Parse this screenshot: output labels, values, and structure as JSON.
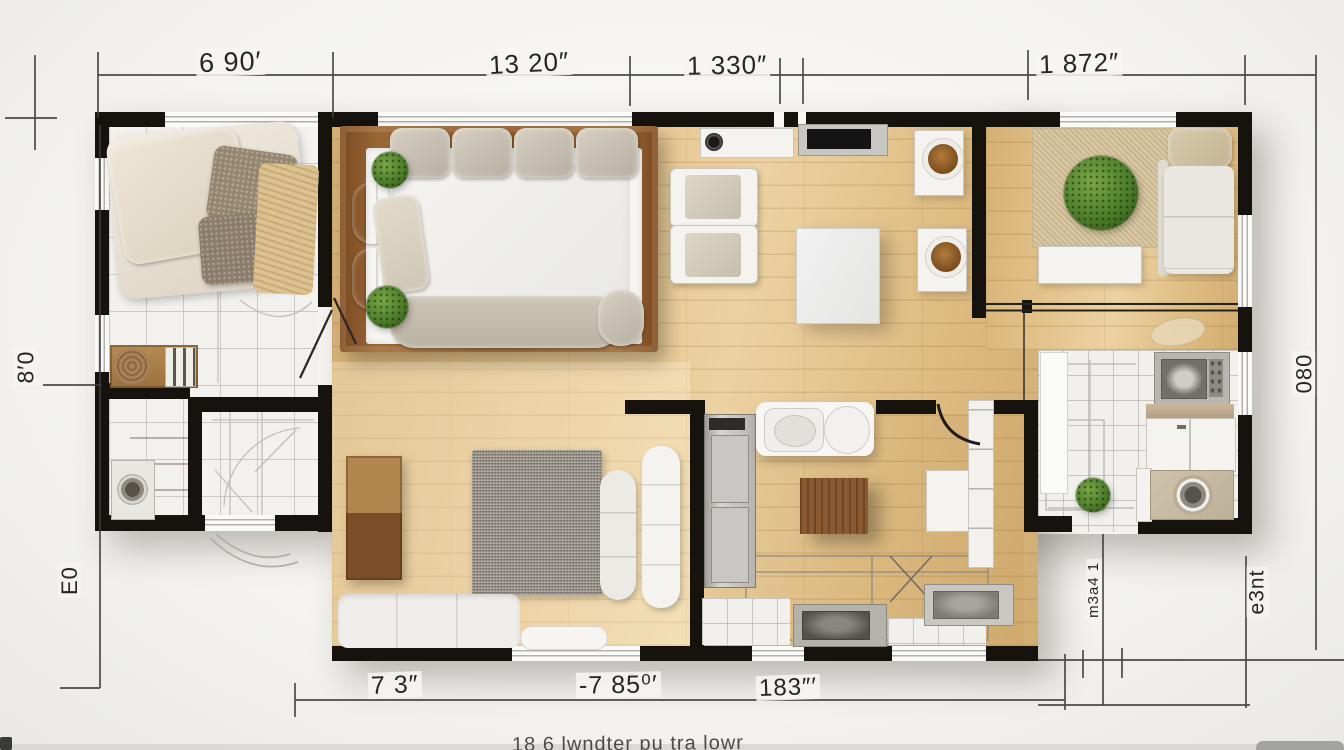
{
  "dimensions": {
    "top": [
      "6 90′",
      "13 20″",
      "1 330″",
      "1 872″"
    ],
    "left": [
      "8′0",
      "E0"
    ],
    "right": [
      "080",
      "e3nt",
      "m3a4 1"
    ],
    "bottom": [
      "7 3″",
      "-7 85⁰′",
      "183″′"
    ]
  },
  "caption": "18 6 lwndter pu tra lowr",
  "colors": {
    "wall": "#16120d",
    "wood_floor": "#ddbc83",
    "tile_floor": "#f2f1ee",
    "dark_wood": "#8a5a32",
    "plant_green": "#4e7d2a",
    "rug_gray": "#989187",
    "rug_beige": "#d8c8a3"
  }
}
